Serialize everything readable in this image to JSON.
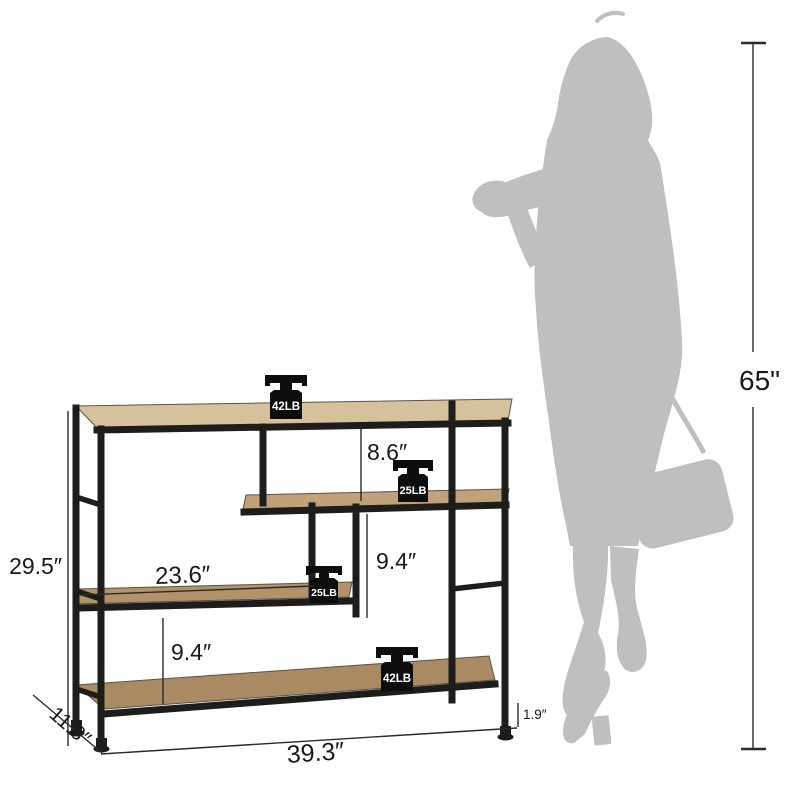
{
  "figure": {
    "description": "Industrial console table / bookshelf dimension diagram with human silhouette for scale",
    "colors": {
      "frame": "#1d1d1b",
      "wood_top": "#d5c29c",
      "wood_middle": "#c0a17a",
      "wood_lower": "#b3926a",
      "wood_bottom": "#a98a63",
      "silhouette": "#bfbfbf",
      "dimension_text": "#1a1a1a",
      "dimension_line": "#2a2a2a",
      "weight_icon": "#0d0d0d",
      "weight_label": "#ffffff"
    },
    "dimensions": {
      "overall_height": "29.5″",
      "middle_shelf_length": "23.6″",
      "top_to_middle_shelf": "8.6″",
      "middle_to_lower_shelf": "9.4″",
      "lower_to_bottom_shelf": "9.4″",
      "foot_height": "1.9″",
      "overall_width": "39.3″",
      "overall_depth": "11.8″"
    },
    "scale_reference": {
      "person_height": "65\""
    },
    "weights": [
      {
        "label": "42LB"
      },
      {
        "label": "25LB"
      },
      {
        "label": "25LB"
      },
      {
        "label": "42LB"
      }
    ]
  }
}
